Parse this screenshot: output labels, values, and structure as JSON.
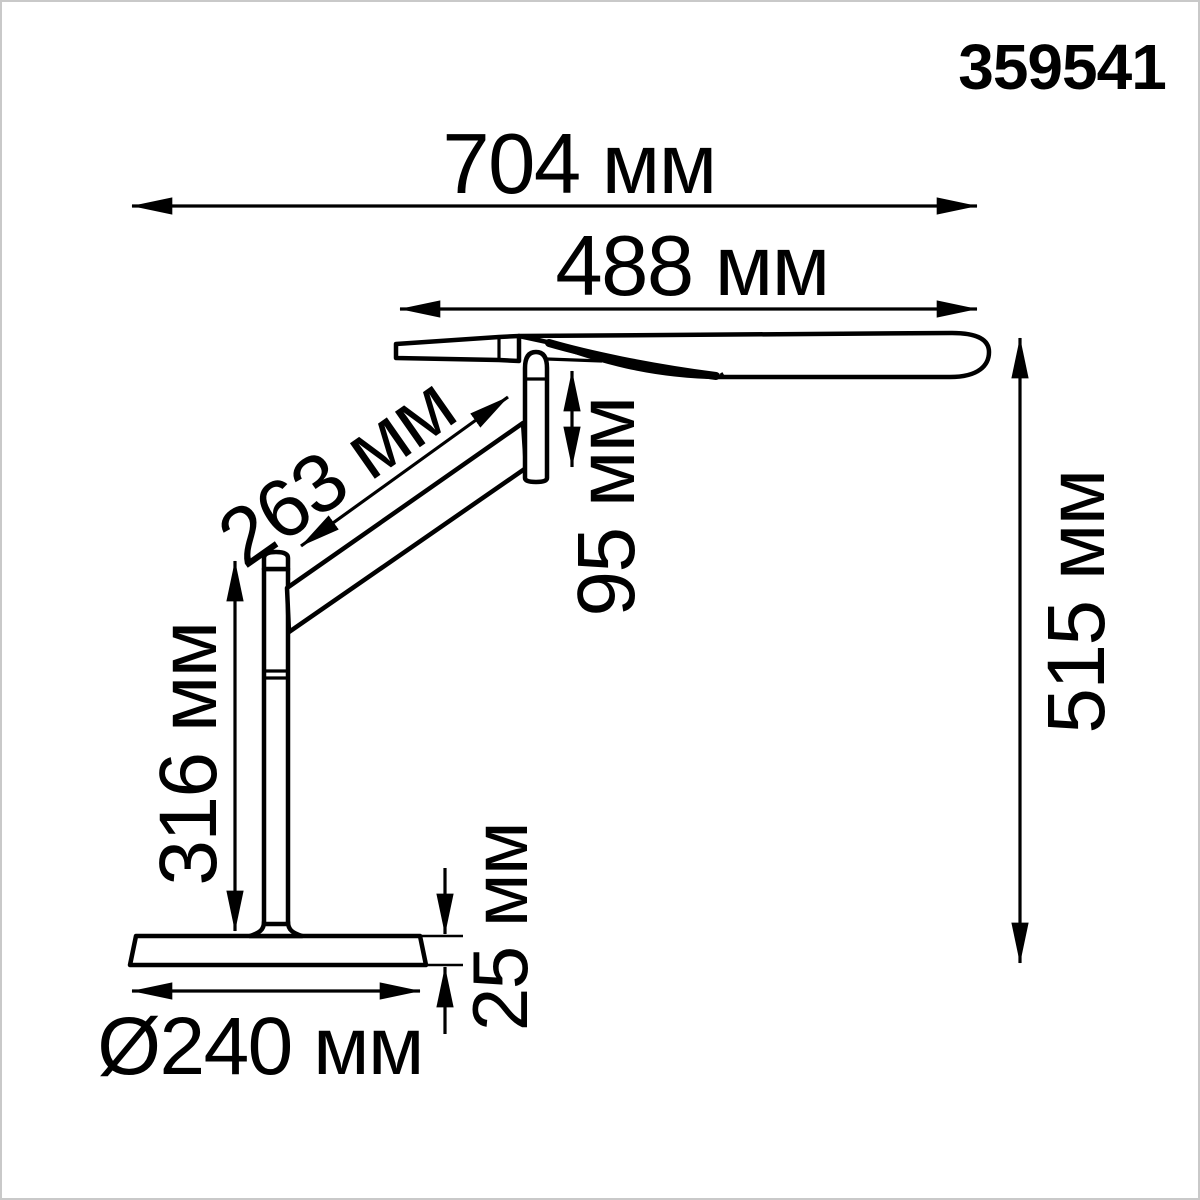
{
  "product_code": "359541",
  "drawing": {
    "type": "technical-dimension-drawing",
    "unit": "мм"
  },
  "dimensions": {
    "overall_width": {
      "value": 704,
      "unit": "мм",
      "label": "704 мм"
    },
    "head_length": {
      "value": 488,
      "unit": "мм",
      "label": "488 мм"
    },
    "arm_length": {
      "value": 263,
      "unit": "мм",
      "label": "263 мм"
    },
    "head_offset": {
      "value": 95,
      "unit": "мм",
      "label": "95 мм"
    },
    "pole_height": {
      "value": 316,
      "unit": "мм",
      "label": "316 мм"
    },
    "overall_height": {
      "value": 515,
      "unit": "мм",
      "label": "515 мм"
    },
    "base_thickness": {
      "value": 25,
      "unit": "мм",
      "label": "25 мм"
    },
    "base_diameter": {
      "value": 240,
      "unit": "мм",
      "label": "Ø240 мм",
      "is_diameter": true
    }
  },
  "colors": {
    "line": "#000000",
    "background": "#ffffff",
    "frame": "#c9c9c9"
  }
}
